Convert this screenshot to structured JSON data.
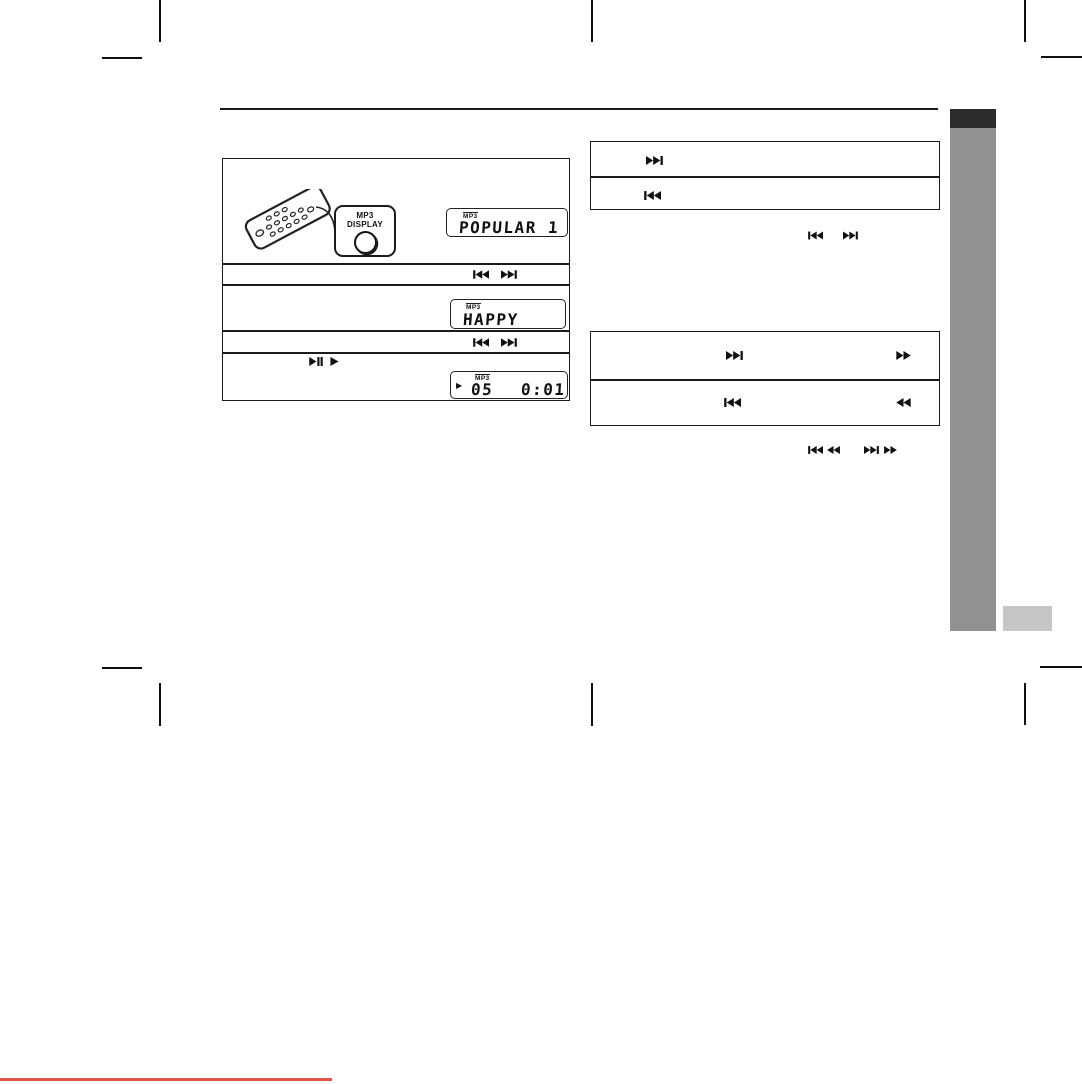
{
  "document": {
    "kind": "scanned audio system user manual page (MP3 playback section)"
  },
  "colors": {
    "line": "#1b1b1b",
    "sidebar_dark": "#2d2d2f",
    "sidebar_gray": "#919191",
    "sidebar_light_tab": "#c6c6c6",
    "scan_red_line": "#e2544b",
    "background": "#ffffff"
  },
  "left_panel": {
    "callout": {
      "line1": "MP3",
      "line2": "DISPLAY"
    },
    "lcd_popular": {
      "badge": "MP3",
      "text": "POPULAR 1"
    },
    "row_skip_1": {
      "icons": [
        "skip-back-icon",
        "skip-forward-icon"
      ]
    },
    "lcd_happy": {
      "badge": "MP3",
      "text": "HAPPY"
    },
    "row_skip_2": {
      "icons": [
        "skip-back-icon",
        "skip-forward-icon"
      ]
    },
    "row_play": {
      "icons": [
        "play-pause-icon",
        "play-icon"
      ]
    },
    "lcd_time": {
      "badge": "MP3",
      "play_indicator": "▶",
      "track": "05",
      "time": "0:01"
    }
  },
  "right_top_box": {
    "rows": [
      {
        "icon": "skip-forward-icon"
      },
      {
        "icon": "skip-back-icon"
      }
    ]
  },
  "right_icon_line_1": {
    "icons": [
      "skip-back-icon",
      "skip-forward-icon"
    ]
  },
  "right_bottom_box": {
    "rows": [
      {
        "icons": [
          "skip-forward-icon",
          "fast-forward-icon"
        ]
      },
      {
        "icons": [
          "skip-back-icon",
          "rewind-icon"
        ]
      }
    ]
  },
  "right_icon_line_2": {
    "icons": [
      "skip-back-icon",
      "rewind-icon",
      "skip-forward-icon",
      "fast-forward-icon"
    ]
  }
}
